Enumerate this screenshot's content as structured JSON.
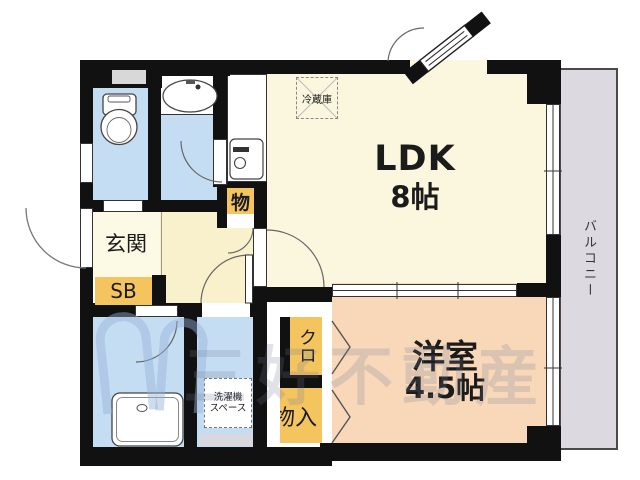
{
  "plan_title": "apartment-floor-plan",
  "rooms": {
    "ldk": {
      "name": "LDK",
      "size": "8帖"
    },
    "western_room": {
      "name": "洋室",
      "size": "4.5帖"
    },
    "entrance": {
      "label": "玄関"
    },
    "shoe_box": {
      "label": "SB"
    },
    "closet": {
      "label": "クロ"
    },
    "storage": {
      "label": "物入"
    },
    "cupboard": {
      "label": "物"
    },
    "washer_space": {
      "line1": "洗濯機",
      "line2": "スペース"
    },
    "refrigerator": {
      "label": "冷蔵庫"
    },
    "balcony": {
      "label": "バルコニー"
    }
  },
  "watermark": {
    "text": "三好不動産"
  },
  "colors": {
    "wall": "#111111",
    "wet_room_floor": "#C5DDF3",
    "ldk_floor": "#FBF6DE",
    "hall_floor": "#F8F1CC",
    "entrance_floor": "#FCF9E5",
    "tatami_room_floor": "#F8D8B8",
    "storage_accent": "#F4C45F",
    "balcony": "#DDD9E1"
  },
  "fixtures": [
    "toilet",
    "washbasin",
    "bathtub",
    "kitchen-sink",
    "washing-machine-space",
    "refrigerator",
    "hinged-doors",
    "sliding-windows",
    "folding-closet-doors"
  ]
}
